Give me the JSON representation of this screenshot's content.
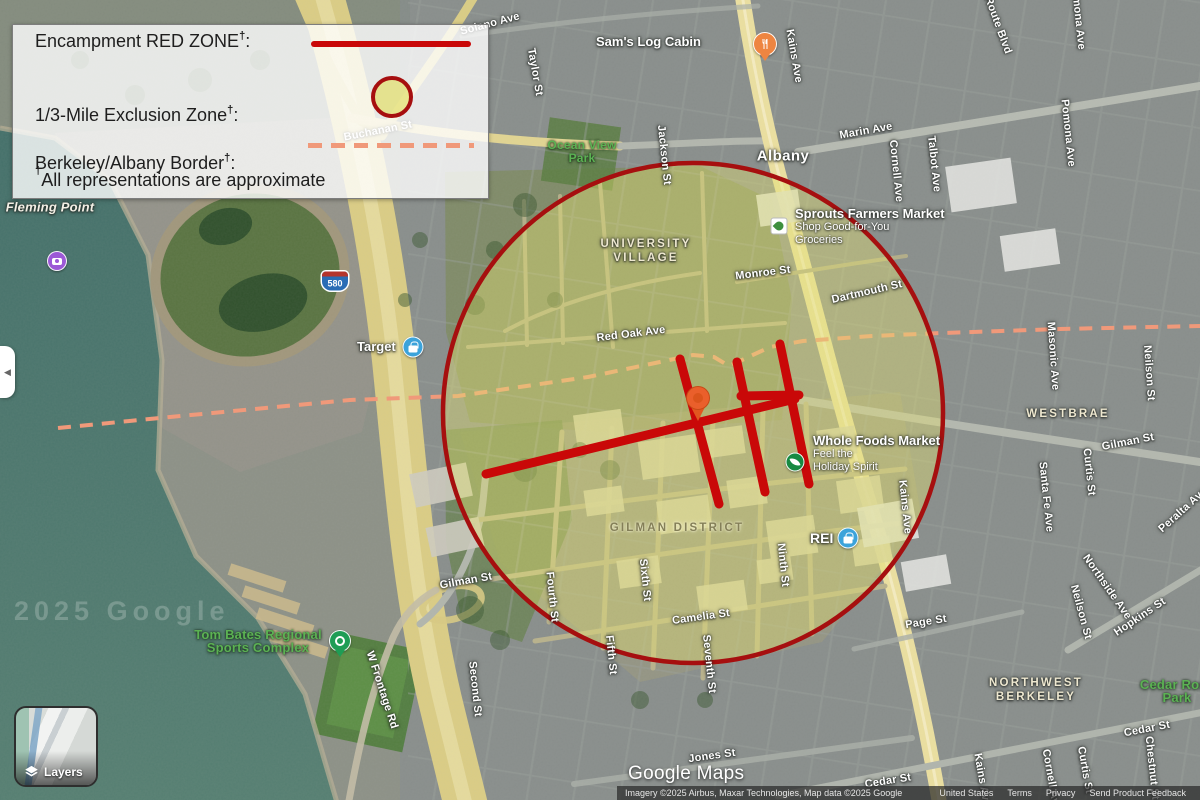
{
  "legend": {
    "items": [
      {
        "label": "Encampment RED ZONE",
        "dagger": "†",
        "suffix": ":"
      },
      {
        "label": "1/3-Mile Exclusion Zone",
        "dagger": "†",
        "suffix": ":"
      },
      {
        "label": "Berkeley/Albany Border",
        "dagger": "†",
        "suffix": ":"
      }
    ],
    "footnote_dagger": "†",
    "footnote": "All representations are approximate"
  },
  "map": {
    "city": "Albany",
    "districts": {
      "university_village": "UNIVERSITY VILLAGE",
      "gilman_district": "GILMAN DISTRICT",
      "westbrae": "WESTBRAE",
      "northwest_berkeley": "NORTHWEST BERKELEY"
    },
    "streets": {
      "solano": "Solano Ave",
      "taylor": "Taylor St",
      "jackson": "Jackson St",
      "kains": "Kains Ave",
      "marin": "Marin Ave",
      "cornell": "Cornell Ave",
      "talbot": "Talbot Ave",
      "pomona": "Pomona Ave",
      "ramona": "Ramona Ave",
      "key_route": "Key Route Blvd",
      "masonic": "Masonic Ave",
      "neilson": "Neilson St",
      "gilman": "Gilman St",
      "curtis": "Curtis St",
      "santa_fe": "Santa Fe Ave",
      "monroe": "Monroe St",
      "dartmouth": "Dartmouth St",
      "red_oak": "Red Oak Ave",
      "buchanan": "Buchanan St",
      "sixth": "Sixth St",
      "fourth": "Fourth St",
      "fifth": "Fifth St",
      "camelia": "Camelia St",
      "seventh": "Seventh St",
      "ninth": "Ninth St",
      "second": "Second St",
      "page": "Page St",
      "northside": "Northside Ave",
      "hopkins": "Hopkins St",
      "cedar": "Cedar St",
      "jones": "Jones St",
      "chestnut": "Chestnut St",
      "peralta": "Peralta Ave",
      "w_frontage": "W Frontage Rd"
    },
    "places": {
      "fleming_point": "Fleming Point",
      "ocean_view_park": "Ocean View Park",
      "tom_bates": "Tom Bates Regional Sports Complex",
      "cedar_rose_park": "Cedar Rose Park",
      "sams_log_cabin": "Sam's Log Cabin",
      "sprouts": {
        "name": "Sprouts Farmers Market",
        "line2": "Shop Good-for-You",
        "line3": "Groceries"
      },
      "whole_foods": {
        "name": "Whole Foods Market",
        "line2": "Feel the",
        "line3": "Holiday Spirit"
      },
      "rei": "REI",
      "target": "Target"
    },
    "badges": {
      "interstate": "580"
    }
  },
  "controls": {
    "layers": "Layers",
    "collapse_arrow": "◀"
  },
  "branding": {
    "logo": "Google Maps",
    "watermark": "2025 Google"
  },
  "attribution": {
    "imagery": "Imagery ©2025 Airbus, Maxar Technologies, Map data ©2025 Google",
    "region": "United States",
    "terms": "Terms",
    "privacy": "Privacy",
    "feedback": "Send Product Feedback"
  },
  "colors": {
    "red_zone": "#C90808",
    "exclusion_fill": "#E3DF72",
    "exclusion_stroke": "#A60F0F",
    "border_dash": "#F0997A",
    "freeway_yellow": "#DBCD85",
    "san_pablo_yellow": "#ECE0A0",
    "water": "#4A796D"
  }
}
